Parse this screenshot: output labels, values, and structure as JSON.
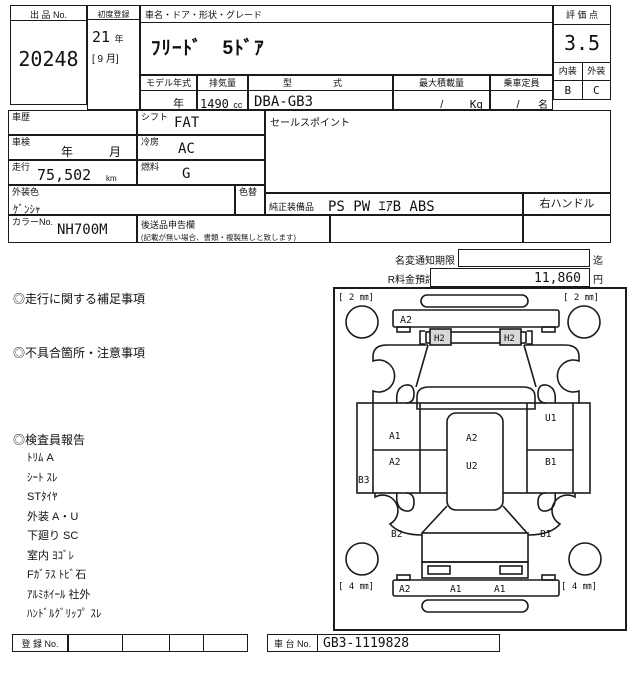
{
  "doc": {
    "lot_label": "出 品 No.",
    "lot_no": "20248",
    "first_reg_label": "初度登録",
    "first_reg_year": "21",
    "first_reg_year_unit": "年",
    "first_reg_month": "[ 9 月]",
    "name_header": "車名・ドア・形状・グレード",
    "car_name": "ﾌﾘｰﾄﾞ　5ﾄﾞｱ",
    "score_label": "評 価 点",
    "score": "3.5",
    "interior_label": "内装",
    "exterior_label": "外装",
    "interior_grade": "B",
    "exterior_grade": "C",
    "model_year_label": "モデル年式",
    "model_year_value": "年",
    "disp_label": "排気量",
    "disp_value": "1490",
    "disp_unit": "cc",
    "model_code_label": "型　式",
    "model_code": "DBA-GB3",
    "max_load_label": "最大積載量",
    "max_load_value": "/",
    "max_load_unit": "Kg",
    "capacity_label": "乗車定員",
    "capacity_value": "/",
    "capacity_unit": "名",
    "history_label": "車歴",
    "shift_label": "シフト",
    "shift_value": "FAT",
    "inspection_label": "車検",
    "inspection_year": "年",
    "inspection_month": "月",
    "ac_label": "冷房",
    "ac_value": "AC",
    "mileage_label": "走行",
    "mileage_value": "75,502",
    "mileage_unit": "km",
    "fuel_label": "燃料",
    "fuel_value": "G",
    "color_label": "外装色",
    "color_value": "ｹﾞﾝｼｬ",
    "color_change_label": "色替",
    "color_no_label": "カラーNo.",
    "color_no": "NH700M",
    "later_label": "後送品申告欄",
    "later_note": "(記載が無い場合、書類・複製無しと致します)",
    "sales_label": "セールスポイント",
    "equip_label": "純正装備品",
    "equip_value": "PS PW ｴｱB ABS",
    "handle_value": "右ハンドル",
    "name_change_label": "名変通知期限",
    "name_change_suffix": "迄",
    "recycle_label": "R料金預託済額",
    "recycle_value": "11,860",
    "recycle_unit": "円",
    "sec_driving": "◎走行に関する補足事項",
    "sec_defects": "◎不具合箇所・注意事項",
    "sec_inspector": "◎検査員報告",
    "inspector_items": [
      "ﾄﾘﾑ A",
      "ｼｰﾄ ｽﾚ",
      "STﾀｲﾔ",
      "外装 A・U",
      "下廻り SC",
      "室内 ﾖｺﾞﾚ",
      "Fｶﾞﾗｽ ﾄﾋﾞ石",
      "ｱﾙﾐﾎｲｰﾙ 社外",
      "ﾊﾝﾄﾞﾙｸﾞﾘｯﾌﾟ ｽﾚ"
    ],
    "reg_label": "登 録 No.",
    "chassis_label": "車 台 No.",
    "chassis_no": "GB3-1119828"
  },
  "diagram": {
    "tread_fl": "[ 2 ㎜]",
    "tread_fr": "[ 2 ㎜]",
    "tread_rl": "[ 4 ㎜]",
    "tread_rr": "[ 4 ㎜]",
    "front_bumper": "A2",
    "headlight_l": "H2",
    "headlight_r": "H2",
    "door_l_top": "A1",
    "door_l_bottom": "A2",
    "rocker_l": "B3",
    "roof": "A2",
    "floor": "U2",
    "side_r_top": "U1",
    "side_r_bottom": "B1",
    "quarter_l": "B2",
    "quarter_r": "B1",
    "rear_bumper_1": "A2",
    "rear_bumper_2": "A1",
    "rear_bumper_3": "A1",
    "line_color": "#1a1a1a",
    "light_fill": "#d8d8d8"
  }
}
